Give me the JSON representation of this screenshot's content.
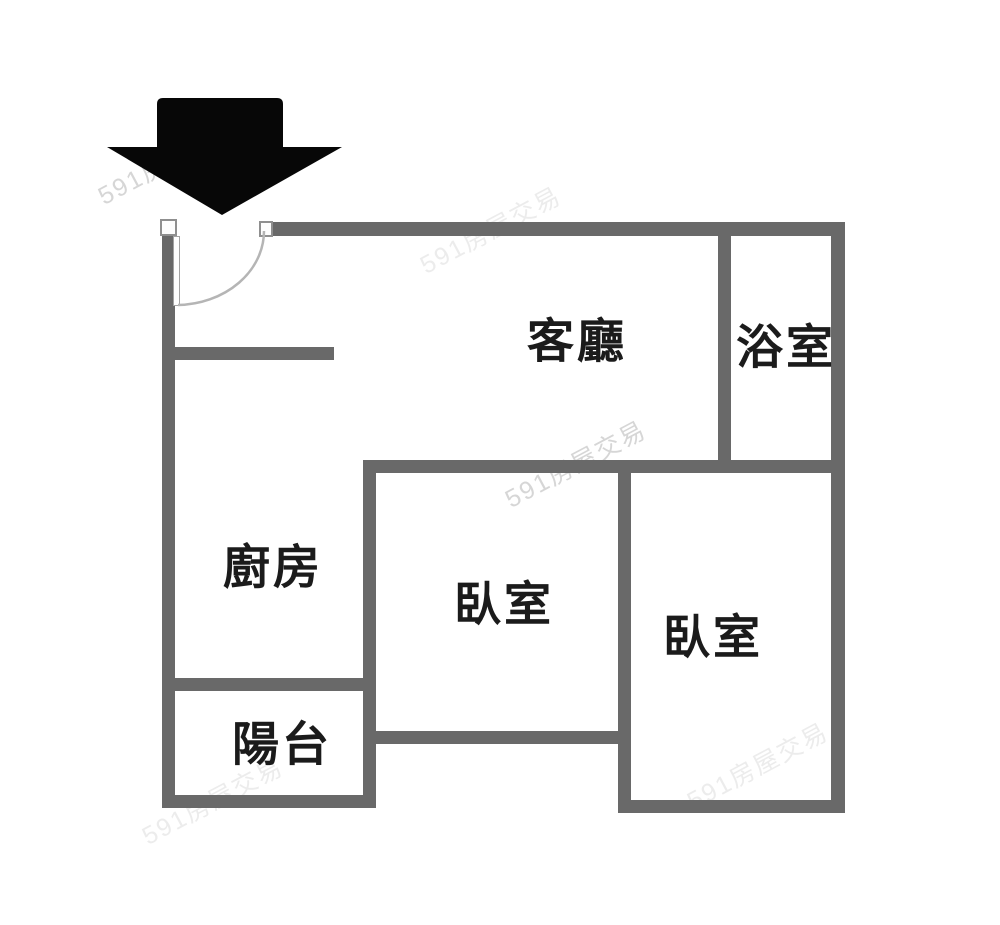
{
  "floorplan": {
    "background_color": "#ffffff",
    "wall_color": "#696969",
    "label_color": "#1b1b1b",
    "entrance_arrow_color": "#070707",
    "door_swing_color": "#b5b5b5",
    "rooms": {
      "living_room": {
        "label": "客廳"
      },
      "bathroom": {
        "label": "浴室"
      },
      "kitchen": {
        "label": "廚房"
      },
      "bedroom_1": {
        "label": "臥室"
      },
      "bedroom_2": {
        "label": "臥室"
      },
      "balcony": {
        "label": "陽台"
      }
    },
    "watermark": {
      "text": "591房屋交易"
    }
  }
}
